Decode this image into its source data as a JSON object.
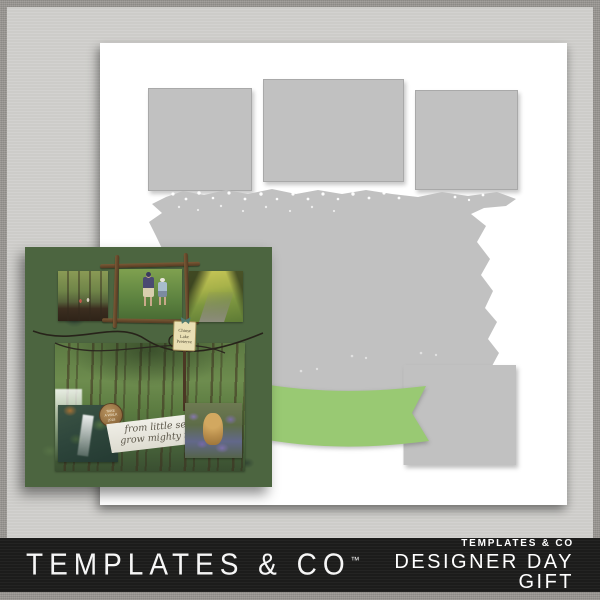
{
  "background": {
    "frame_color": "#9a9793",
    "mat_color": "#cdccc9"
  },
  "template_preview": {
    "page_color": "#ffffff",
    "placeholder_color": "#c1c1c1",
    "ribbon_color": "#99c973",
    "elements": [
      "photo-placeholder-left",
      "photo-placeholder-center",
      "photo-placeholder-right",
      "paint-splash-mask",
      "photo-placeholder-bottom-right",
      "curved-ribbon-banner"
    ]
  },
  "sample_layout": {
    "background_color": "#4c6540",
    "photos": [
      "forest-hike-group",
      "kids-walking-twig-frame",
      "sunlit-forest-path",
      "tall-forest-trees",
      "creek-waterfall",
      "dog-in-bluebells"
    ],
    "tag": {
      "lines": [
        "Chinse",
        "Lake",
        "Preserve"
      ]
    },
    "wood_badge": {
      "lines": [
        "TAKE",
        "A WALK",
        "2018"
      ]
    },
    "banner": {
      "lines": [
        "from little seeds",
        "grow mighty trees"
      ]
    }
  },
  "footer": {
    "background_color": "#1c1c1b",
    "brand": "TEMPLATES & CO",
    "trademark": "™",
    "collection": "TEMPLATES & CO",
    "product": "DESIGNER DAY GIFT"
  }
}
